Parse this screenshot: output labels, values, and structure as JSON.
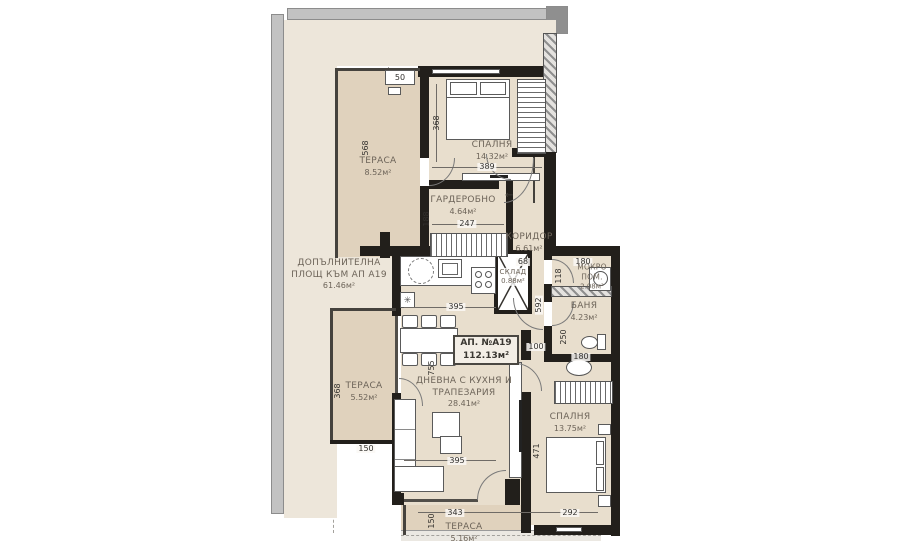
{
  "plan": {
    "apartment_box": {
      "number": "АП. №А19",
      "area": "112.13м²"
    },
    "additional_area": {
      "line1": "ДОПЪЛНИТЕЛНА",
      "line2": "ПЛОЩ КЪМ АП А19",
      "area": "61.46м²"
    },
    "rooms": {
      "terrace_top": {
        "name": "ТЕРАСА",
        "area": "8.52м²"
      },
      "bedroom_top": {
        "name": "СПАЛНЯ",
        "area": "14.32м²"
      },
      "closet": {
        "name": "ГАРДЕРОБНО",
        "area": "4.64м²"
      },
      "corridor": {
        "name": "КОРИДОР",
        "area": "6.61м²"
      },
      "storage": {
        "name": "СКЛАД",
        "area": "0.88м²"
      },
      "wet_room": {
        "name1": "МОКРО",
        "name2": "ПОМ.",
        "area": "2.08м²"
      },
      "bathroom": {
        "name": "БАНЯ",
        "area": "4.23м²"
      },
      "living": {
        "name1": "ДНЕВНА С КУХНЯ И",
        "name2": "ТРАПЕЗАРИЯ",
        "area": "28.41м²"
      },
      "bedroom_bottom": {
        "name": "СПАЛНЯ",
        "area": "13.75м²"
      },
      "terrace_left": {
        "name": "ТЕРАСА",
        "area": "5.52м²"
      },
      "terrace_bottom": {
        "name": "ТЕРАСА",
        "area": "5.16м²"
      }
    },
    "dims": {
      "shelf": "50",
      "terrace_top_h": "568",
      "bedroom_top_h": "368",
      "bedroom_top_w": "389",
      "closet_h": "188",
      "closet_w": "247",
      "storage_w": "68",
      "corridor_h": "592",
      "wet_w": "180",
      "wet_h": "118",
      "bath_h": "250",
      "vanity_w": "180",
      "door_w": "100",
      "kitchen_w": "395",
      "living_h": "755",
      "living_w": "395",
      "terrace_left_h": "368",
      "terrace_left_w": "150",
      "bedroom_bottom_h": "471",
      "terrace_bottom_w": "343",
      "bedroom_bottom_w": "292",
      "terrace_bottom_h": "150"
    },
    "icons": {
      "entrance_arrow": "←",
      "fridge": "✳"
    },
    "colors": {
      "wall": "#221f1b",
      "room_floor": "#e8decd",
      "terrace_floor": "#e0d2bd",
      "outdoor": "#ede6da"
    }
  }
}
